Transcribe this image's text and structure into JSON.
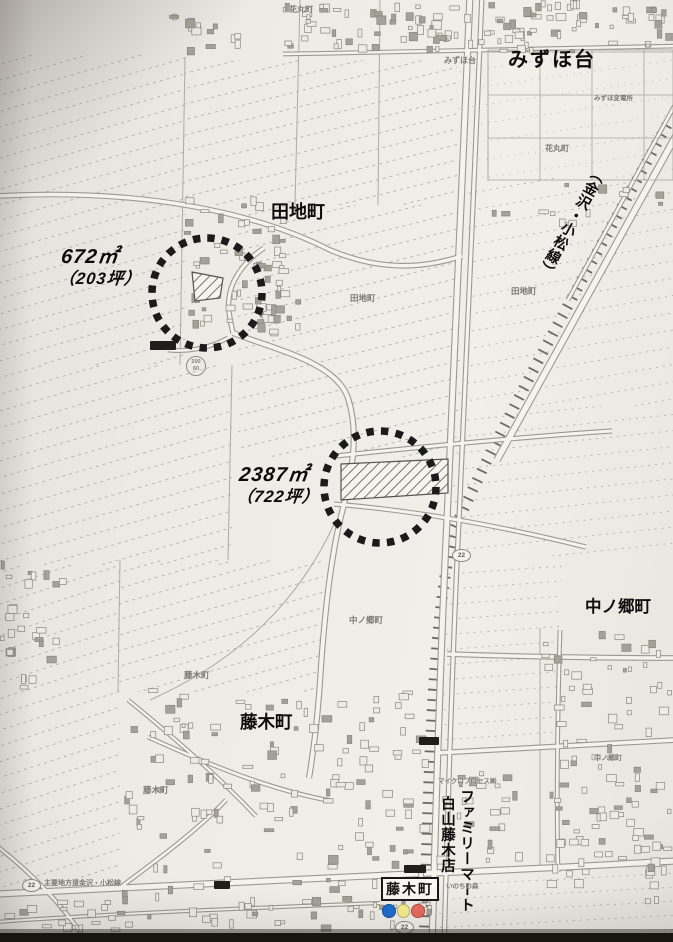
{
  "map": {
    "region_labels": {
      "mizuhodai": "みずほ台",
      "tajicho": "田地町",
      "nakanogocho": "中ノ郷町",
      "fujikicho": "藤木町"
    },
    "parcels": [
      {
        "area_m2": "672㎡",
        "area_tsubo": "（203坪）"
      },
      {
        "area_m2": "2387㎡",
        "area_tsubo": "（722坪）"
      }
    ],
    "road_label": "（金沢・小松線）",
    "store_label": {
      "line1": "ファミリーマート",
      "line2": "白山藤木店"
    },
    "signal": {
      "label": "藤木町",
      "colors": {
        "blue": "#1d6cd0",
        "yellow": "#f6ef8e",
        "red": "#e9695f"
      }
    },
    "route_shields": [
      "22",
      "22",
      "22"
    ],
    "benchmark": {
      "top": "200",
      "bottom": "60"
    },
    "small_labels": [
      {
        "text": "花丸町"
      },
      {
        "text": "みずほ台"
      },
      {
        "text": "みずほ変電所"
      },
      {
        "text": "花丸町"
      },
      {
        "text": "田地町"
      },
      {
        "text": "田地町"
      },
      {
        "text": "中ノ郷町"
      },
      {
        "text": "中ノ郷町"
      },
      {
        "text": "藤木町"
      },
      {
        "text": "藤木町"
      },
      {
        "text": "マイクロプロセス㈱"
      },
      {
        "text": "いのちの森"
      },
      {
        "text": "主要地方道金沢・小松線"
      }
    ],
    "highlight_color": "#1b1b1b"
  }
}
